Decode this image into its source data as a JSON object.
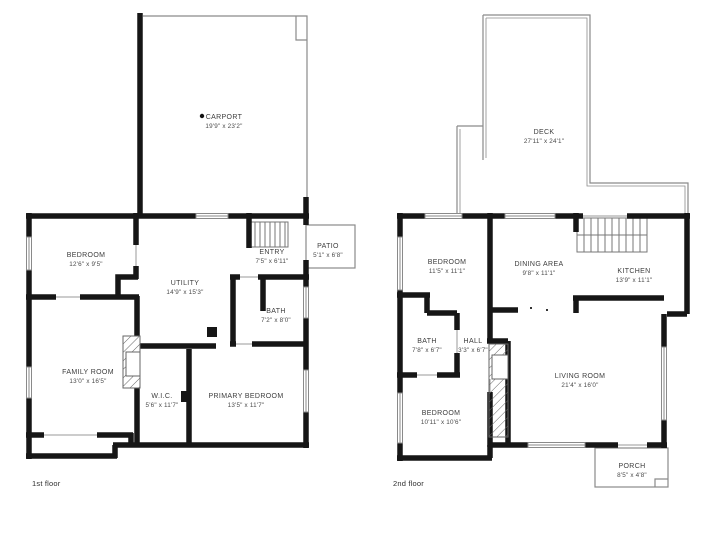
{
  "title": "Two-story house floor plan",
  "colors": {
    "wall": "#161616",
    "thin_line": "#8a8a8a",
    "stair_line": "#666666",
    "label_text": "#3d3d3d",
    "background": "#ffffff"
  },
  "floors": [
    {
      "label": "1st floor",
      "rooms": [
        {
          "name": "CARPORT",
          "dims": "19'9\" x 23'2\""
        },
        {
          "name": "BEDROOM",
          "dims": "12'6\" x 9'5\""
        },
        {
          "name": "UTILITY",
          "dims": "14'9\" x 15'3\""
        },
        {
          "name": "ENTRY",
          "dims": "7'5\" x 6'11\""
        },
        {
          "name": "PATIO",
          "dims": "5'1\" x 6'8\""
        },
        {
          "name": "BATH",
          "dims": "7'2\" x 8'0\""
        },
        {
          "name": "FAMILY ROOM",
          "dims": "13'0\" x 16'5\""
        },
        {
          "name": "W.I.C.",
          "dims": "5'6\" x 11'7\""
        },
        {
          "name": "PRIMARY BEDROOM",
          "dims": "13'5\" x 11'7\""
        }
      ]
    },
    {
      "label": "2nd floor",
      "rooms": [
        {
          "name": "DECK",
          "dims": "27'11\" x 24'1\""
        },
        {
          "name": "BEDROOM",
          "dims": "11'5\" x 11'1\""
        },
        {
          "name": "DINING AREA",
          "dims": "9'8\" x 11'1\""
        },
        {
          "name": "KITCHEN",
          "dims": "13'9\" x 11'1\""
        },
        {
          "name": "BATH",
          "dims": "7'8\" x 6'7\""
        },
        {
          "name": "HALL",
          "dims": "3'3\" x 6'7\""
        },
        {
          "name": "LIVING ROOM",
          "dims": "21'4\" x 16'0\""
        },
        {
          "name": "BEDROOM",
          "dims": "10'11\" x 10'6\""
        },
        {
          "name": "PORCH",
          "dims": "8'5\" x 4'8\""
        }
      ]
    }
  ]
}
